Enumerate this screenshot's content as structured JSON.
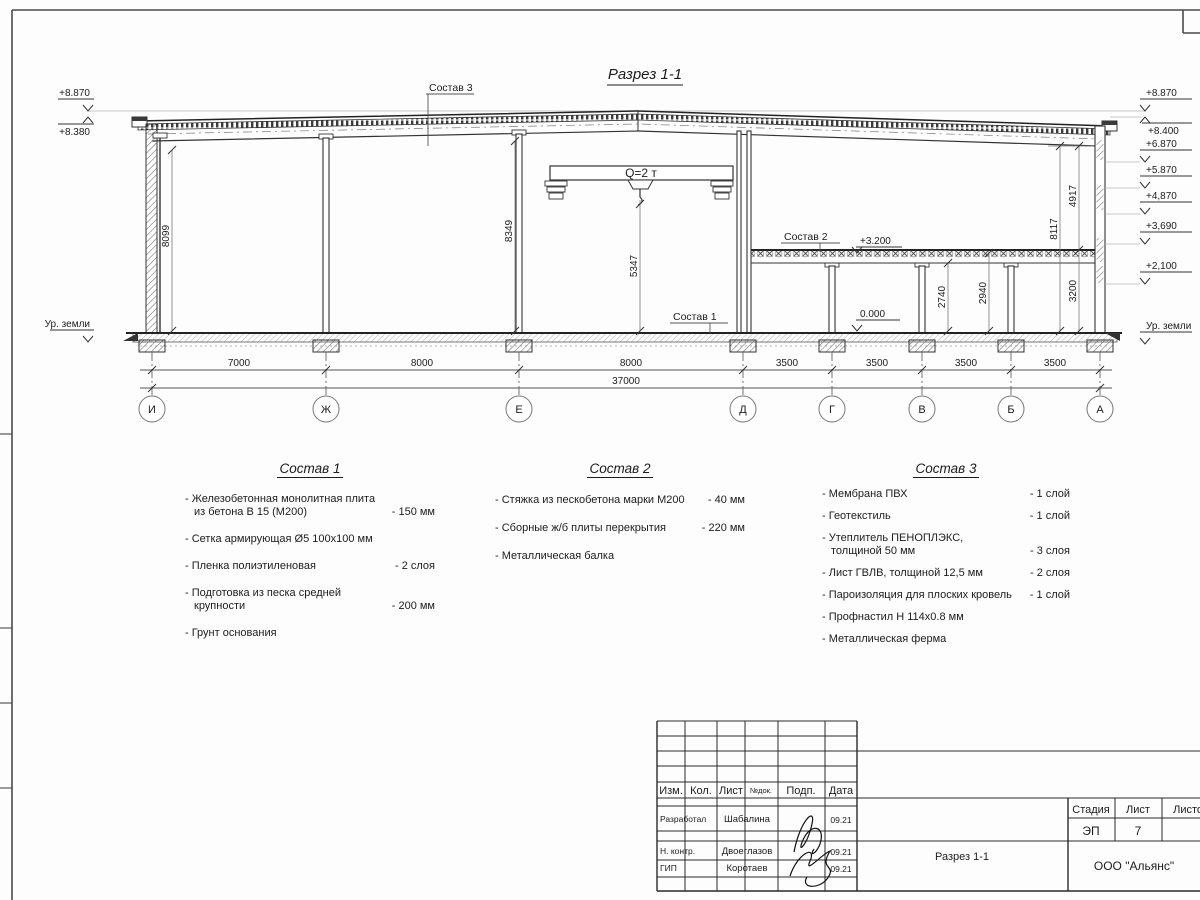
{
  "drawing": {
    "title": "Разрез 1-1",
    "crane_label": "Q=2 т",
    "callouts": {
      "roof": "Состав 3",
      "slab": "Состав 2",
      "floor": "Состав 1"
    },
    "elev": {
      "left": [
        "+8.870",
        "+8.380",
        "Ур. земли"
      ],
      "right": [
        "+8.870",
        "+8.400",
        "+6.870",
        "+5.870",
        "+4,870",
        "+3,690",
        "+2,100",
        "Ур. земли"
      ],
      "slab": "+3.200",
      "floor": "0.000"
    },
    "vdims": {
      "left_bay": "8099",
      "mid_bay": "8349",
      "crane_hook": "5347",
      "clear_under_slab": "2740",
      "to_slab_top": "2940",
      "storey": "3200",
      "right_full": "8117",
      "right_upper": "4917"
    },
    "spans": [
      "7000",
      "8000",
      "8000",
      "3500",
      "3500",
      "3500",
      "3500"
    ],
    "total_span": "37000",
    "axes": [
      "И",
      "Ж",
      "Е",
      "Д",
      "Г",
      "В",
      "Б",
      "А"
    ]
  },
  "comp1": {
    "title": "Состав 1",
    "items": [
      {
        "text": "- Железобетонная  монолитная плита\nиз бетона В 15 (М200)",
        "value": "- 150 мм"
      },
      {
        "text": "- Сетка армирующая Ø5 100х100 мм",
        "value": ""
      },
      {
        "text": "- Пленка полиэтиленовая",
        "value": "- 2 слоя"
      },
      {
        "text": "- Подготовка из песка средней\nкрупности",
        "value": "- 200 мм"
      },
      {
        "text": "- Грунт основания",
        "value": ""
      }
    ]
  },
  "comp2": {
    "title": "Состав 2",
    "items": [
      {
        "text": "- Стяжка из пескобетона марки М200",
        "value": "- 40 мм"
      },
      {
        "text": "- Сборные ж/б плиты перекрытия",
        "value": "- 220 мм"
      },
      {
        "text": "- Металлическая балка",
        "value": ""
      }
    ]
  },
  "comp3": {
    "title": "Состав 3",
    "items": [
      {
        "text": "- Мембрана ПВХ",
        "value": "- 1 слой"
      },
      {
        "text": "- Геотекстиль",
        "value": "- 1 слой"
      },
      {
        "text": "- Утеплитель ПЕНОПЛЭКС,\nтолщиной 50 мм",
        "value": "- 3 слоя"
      },
      {
        "text": "- Лист ГВЛВ, толщиной 12,5 мм",
        "value": "- 2 слоя"
      },
      {
        "text": "- Пароизоляция для плоских кровель",
        "value": "- 1 слой"
      },
      {
        "text": "- Профнастил Н 114х0.8 мм",
        "value": ""
      },
      {
        "text": "- Металлическая ферма",
        "value": ""
      }
    ]
  },
  "titleblock": {
    "cols": [
      "Изм.",
      "Кол.",
      "Лист",
      "№док.",
      "Подп.",
      "Дата"
    ],
    "rows": [
      {
        "role": "Разработал",
        "name": "Шабалина",
        "date": "09.21"
      },
      {
        "role": "Н. контр.",
        "name": "Двоеглазов",
        "date": "09.21"
      },
      {
        "role": "ГИП",
        "name": "Коротаев",
        "date": "09.21"
      }
    ],
    "doc": "Разрез 1-1",
    "stage_h": "Стадия",
    "sheet_h": "Лист",
    "sheets_h": "Листов",
    "stage": "ЭП",
    "sheet": "7",
    "sheets": "",
    "company": "ООО \"Альянс\""
  }
}
